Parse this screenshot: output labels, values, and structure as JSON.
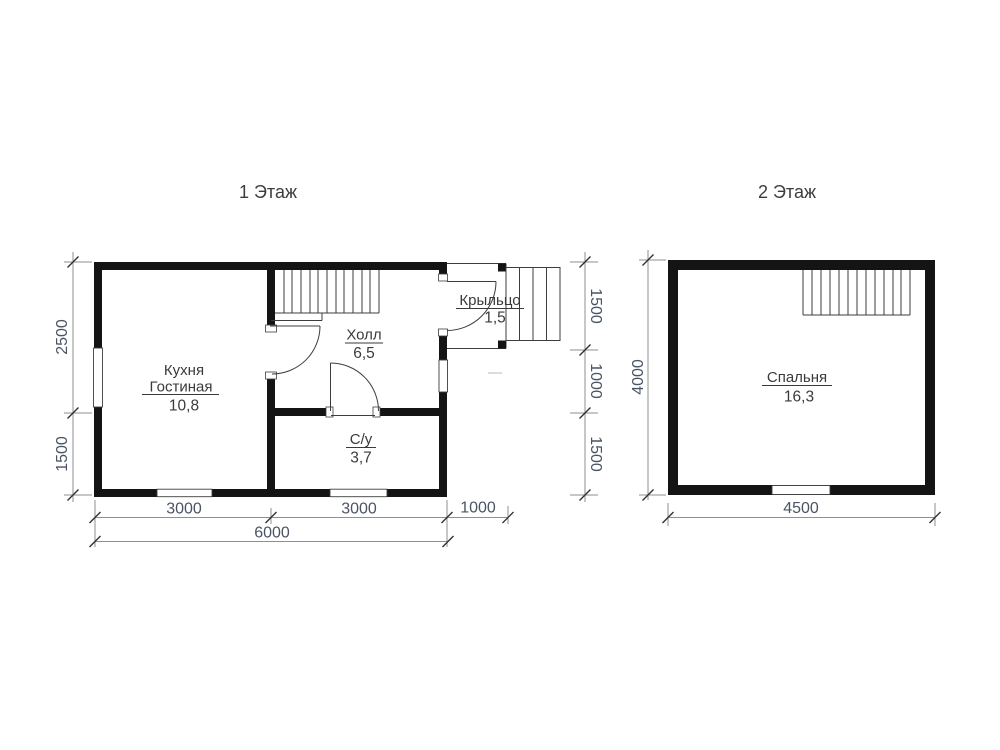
{
  "drawing": {
    "type": "house floor plan, two storeys",
    "colors": {
      "background": "#ffffff",
      "wall": "#141414",
      "thin_line": "#3d3d3d",
      "dimension_line": "#8f8f8f",
      "dimension_text": "#4a5464",
      "label_text": "#3a3a3a"
    }
  },
  "floor1": {
    "title": "1 Этаж",
    "rooms": {
      "kitchen": {
        "line1": "Кухня",
        "line2": "Гостиная",
        "area": "10,8"
      },
      "hall": {
        "name": "Холл",
        "area": "6,5"
      },
      "wc": {
        "name": "С/у",
        "area": "3,7"
      },
      "porch": {
        "name": "Крыльцо",
        "area": "1,5"
      }
    },
    "dims": {
      "left": [
        "2500",
        "1500"
      ],
      "right": [
        "1500",
        "1000",
        "1500"
      ],
      "bottom": [
        "3000",
        "3000",
        "1000"
      ],
      "total": "6000"
    }
  },
  "floor2": {
    "title": "2 Этаж",
    "rooms": {
      "bedroom": {
        "name": "Спальня",
        "area": "16,3"
      }
    },
    "dims": {
      "left": [
        "4000"
      ],
      "bottom": [
        "4500"
      ]
    }
  }
}
